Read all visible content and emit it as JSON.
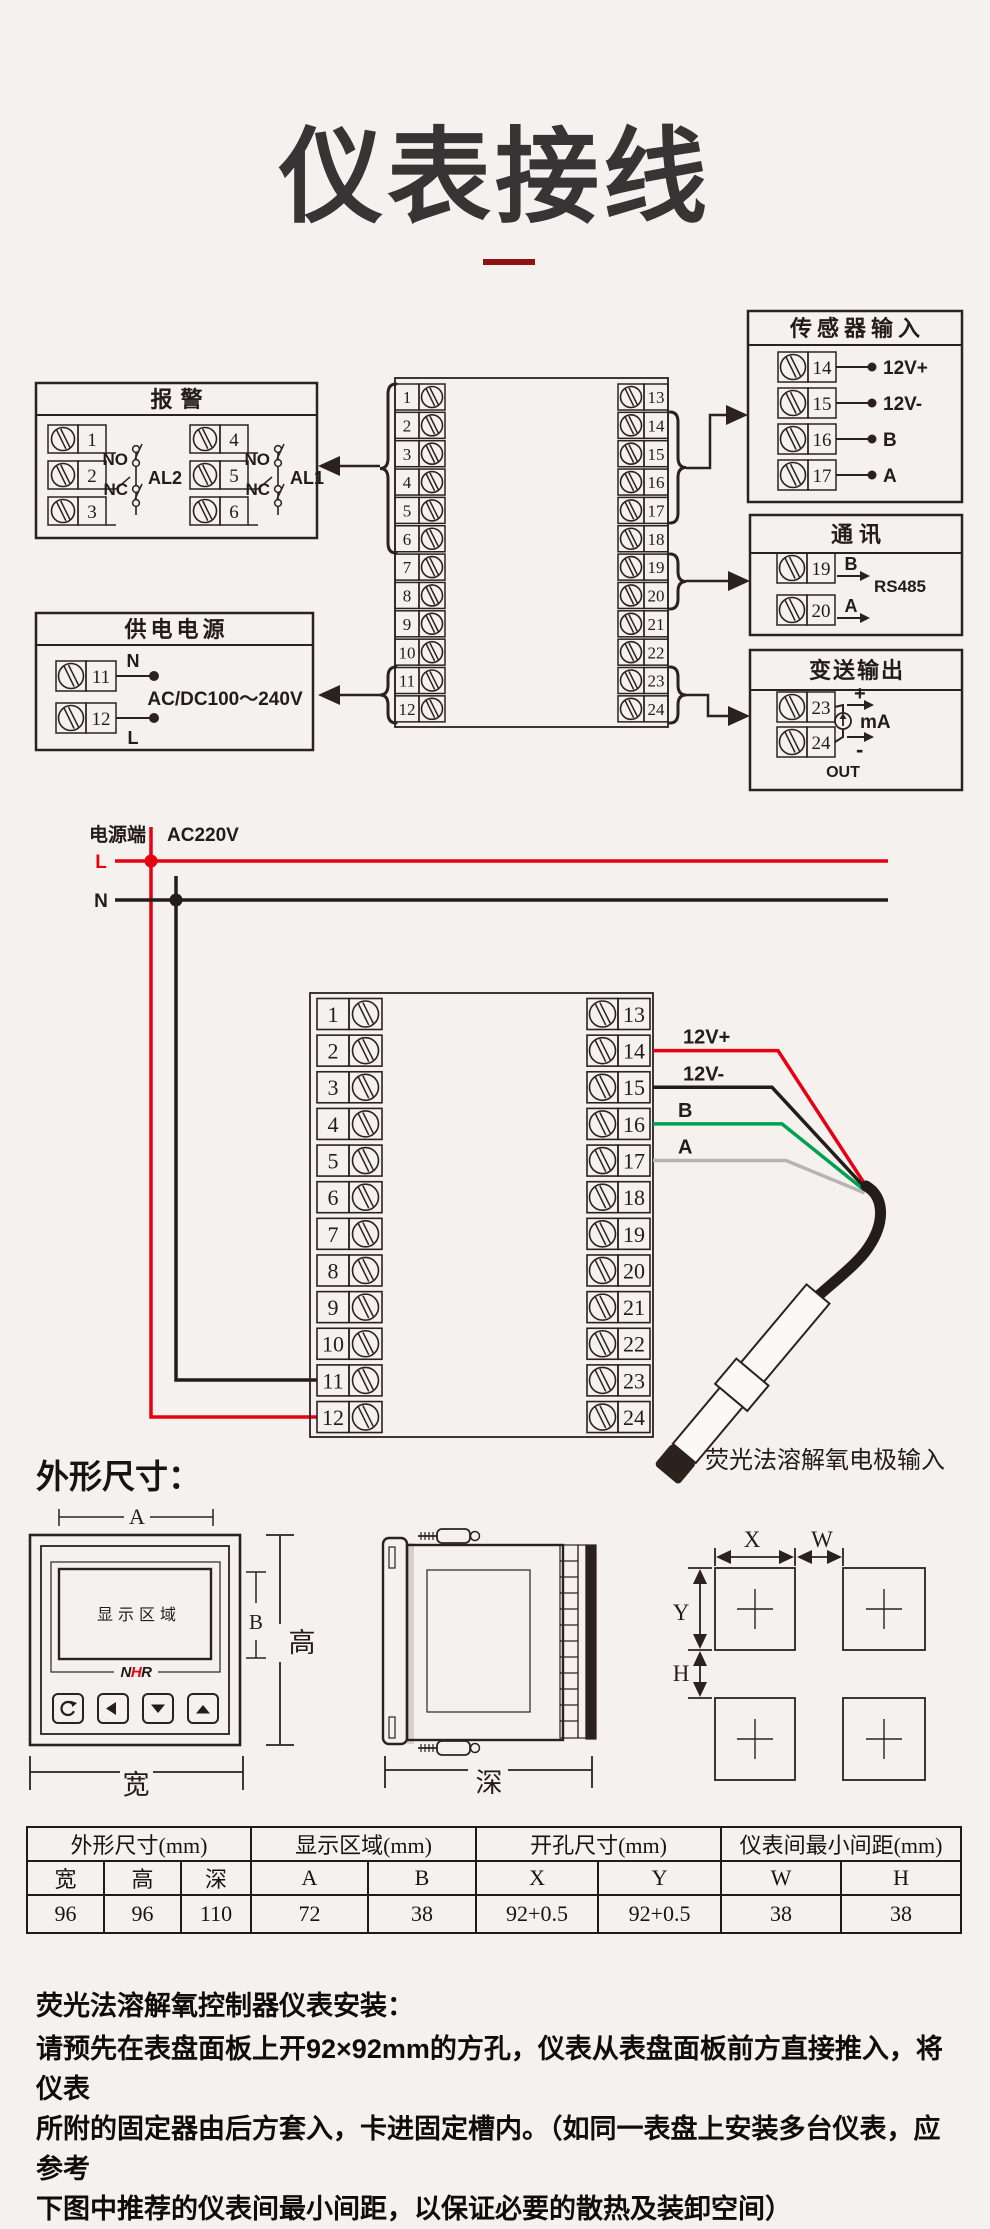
{
  "page": {
    "title": "仪表接线",
    "section_dim_heading": "外形尺寸："
  },
  "colors": {
    "background": "#f5f1ee",
    "line": "#2b221e",
    "text_dark": "#241c18",
    "red": "#e60012",
    "green": "#00a051",
    "gray_wire": "#b5b5b5",
    "black_wire": "#241c18",
    "underline": "#8e1212",
    "logo_red": "#e60012"
  },
  "terminals": {
    "left": [
      "1",
      "2",
      "3",
      "4",
      "5",
      "6",
      "7",
      "8",
      "9",
      "10",
      "11",
      "12"
    ],
    "right": [
      "13",
      "14",
      "15",
      "16",
      "17",
      "18",
      "19",
      "20",
      "21",
      "22",
      "23",
      "24"
    ]
  },
  "alarm_box": {
    "title": "报警",
    "groups": [
      {
        "terminals": [
          "1",
          "2",
          "3"
        ],
        "no": "NO",
        "nc": "NC",
        "label": "AL2"
      },
      {
        "terminals": [
          "4",
          "5",
          "6"
        ],
        "no": "NO",
        "nc": "NC",
        "label": "AL1"
      }
    ]
  },
  "power_box": {
    "title": "供电电源",
    "terminals": [
      "11",
      "12"
    ],
    "n": "N",
    "l": "L",
    "range": "AC/DC100～240V"
  },
  "sensor_box": {
    "title": "传感器输入",
    "rows": [
      {
        "terminal": "14",
        "label": "12V+"
      },
      {
        "terminal": "15",
        "label": "12V-"
      },
      {
        "terminal": "16",
        "label": "B"
      },
      {
        "terminal": "17",
        "label": "A"
      }
    ]
  },
  "comm_box": {
    "title": "通讯",
    "rows": [
      {
        "terminal": "19",
        "label": "B"
      },
      {
        "terminal": "20",
        "label": "A"
      }
    ],
    "protocol": "RS485"
  },
  "output_box": {
    "title": "变送输出",
    "terminals": [
      "23",
      "24"
    ],
    "plus": "+",
    "minus": "-",
    "unit": "mA",
    "out_label": "OUT"
  },
  "power_lines": {
    "source_label": "电源端",
    "voltage": "AC220V",
    "l": "L",
    "n": "N"
  },
  "probe_wires": [
    {
      "terminal": "14",
      "label": "12V+",
      "color": "#e60012"
    },
    {
      "terminal": "15",
      "label": "12V-",
      "color": "#241c18"
    },
    {
      "terminal": "16",
      "label": "B",
      "color": "#00a051"
    },
    {
      "terminal": "17",
      "label": "A",
      "color": "#b5b5b5"
    }
  ],
  "probe": {
    "caption": "荧光法溶解氧电极输入"
  },
  "front_view": {
    "dim_a": "A",
    "dim_b": "B",
    "width": "宽",
    "height": "高",
    "display": "显示区域",
    "logo_n": "N",
    "logo_h": "H",
    "logo_r": "R",
    "button_icons": [
      "return-icon",
      "left-icon",
      "down-icon",
      "up-icon"
    ]
  },
  "side_view": {
    "depth": "深"
  },
  "cutout": {
    "x": "X",
    "w": "W",
    "y": "Y",
    "h": "H"
  },
  "table": {
    "groups": [
      "外形尺寸(mm)",
      "显示区域(mm)",
      "开孔尺寸(mm)",
      "仪表间最小间距(mm)"
    ],
    "headers": [
      "宽",
      "高",
      "深",
      "A",
      "B",
      "X",
      "Y",
      "W",
      "H"
    ],
    "values": [
      "96",
      "96",
      "110",
      "72",
      "38",
      "92+0.5",
      "92+0.5",
      "38",
      "38"
    ]
  },
  "install": {
    "heading": "荧光法溶解氧控制器仪表安装：",
    "lines": [
      "请预先在表盘面板上开92×92mm的方孔，仪表从表盘面板前方直接推入，将仪表",
      "所附的固定器由后方套入，卡进固定槽内。（如同一表盘上安装多台仪表，应参考",
      "下图中推荐的仪表间最小间距，以保证必要的散热及装卸空间）"
    ]
  }
}
